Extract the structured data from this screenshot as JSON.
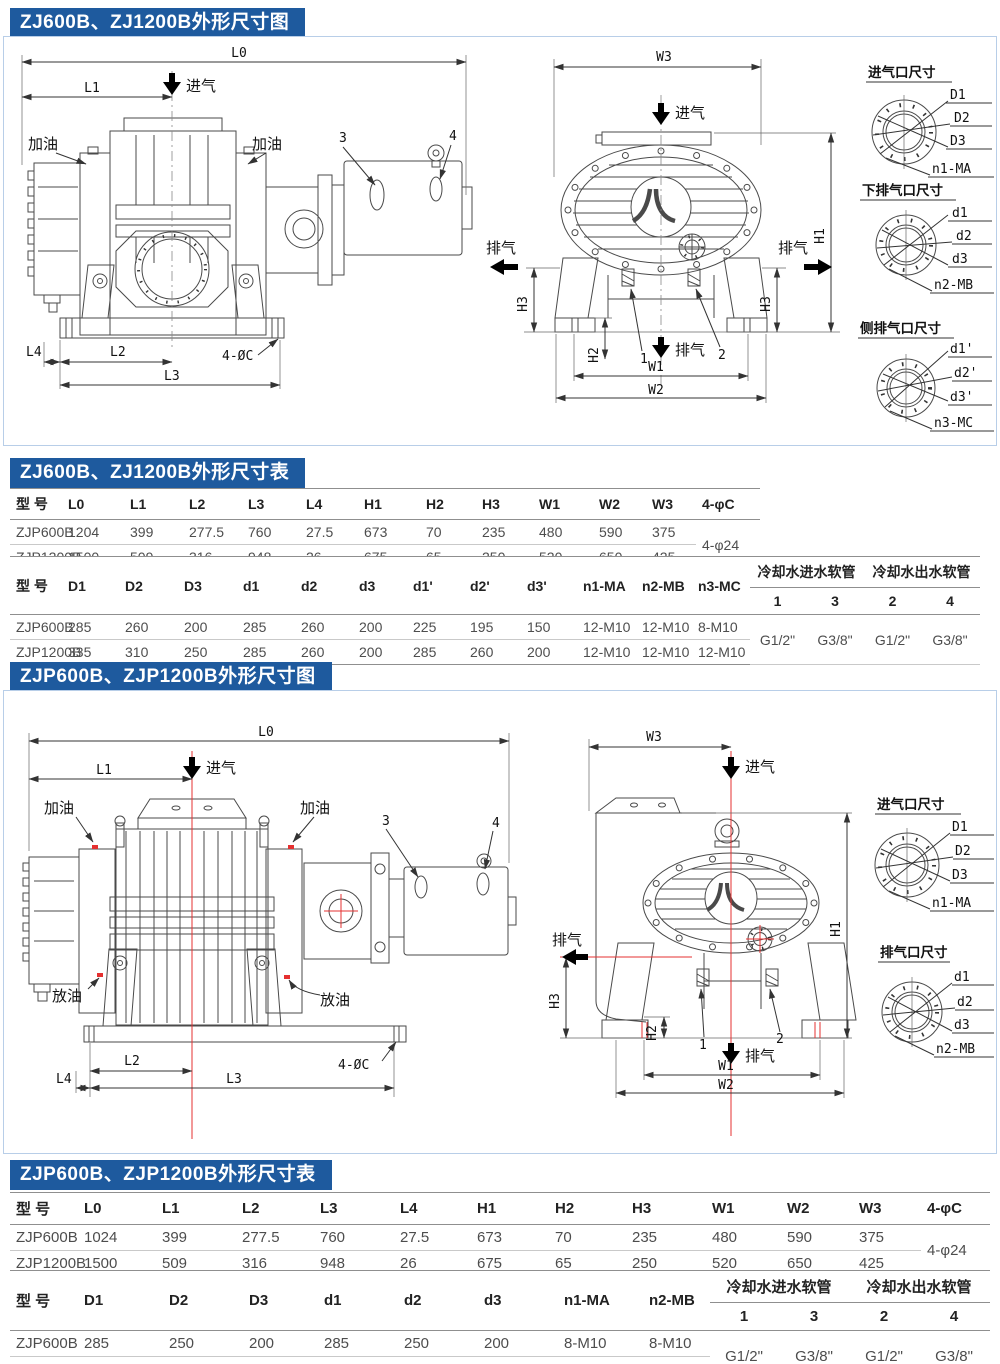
{
  "page": {
    "accent": "#1e5a9e",
    "frame_line": "#b8cee8",
    "centerline_red": "#e53030"
  },
  "fig1": {
    "title": "ZJ600B、ZJ1200B外形尺寸图",
    "side": {
      "l0": "L0",
      "l1": "L1",
      "inlet": "进气",
      "oil_left": "加油",
      "oil_right": "加油",
      "p3": "3",
      "p4": "4",
      "l4": "L4",
      "l2": "L2",
      "l3": "L3",
      "bolt": "4-ØC"
    },
    "front": {
      "w3": "W3",
      "inlet": "进气",
      "ex_left": "排气",
      "ex_right": "排气",
      "h1": "H1",
      "h3l": "H3",
      "h3r": "H3",
      "h2": "H2",
      "p1": "1",
      "p2": "2",
      "ex_bottom": "排气",
      "w1": "W1",
      "w2": "W2"
    },
    "fl1": {
      "title": "进气口尺寸",
      "a": "D1",
      "b": "D2",
      "c": "D3",
      "d": "n1-MA"
    },
    "fl2": {
      "title": "下排气口尺寸",
      "a": "d1",
      "b": "d2",
      "c": "d3",
      "d": "n2-MB"
    },
    "fl3": {
      "title": "侧排气口尺寸",
      "a": "d1'",
      "b": "d2'",
      "c": "d3'",
      "d": "n3-MC"
    }
  },
  "t1": {
    "title": "ZJ600B、ZJ1200B外形尺寸表",
    "p1h": [
      "型 号",
      "L0",
      "L1",
      "L2",
      "L3",
      "L4",
      "H1",
      "H2",
      "H3",
      "W1",
      "W2",
      "W3",
      "4-φC"
    ],
    "p1r0": [
      "ZJP600B",
      "1204",
      "399",
      "277.5",
      "760",
      "27.5",
      "673",
      "70",
      "235",
      "480",
      "590",
      "375"
    ],
    "p1r1": [
      "ZJP1200B",
      "1500",
      "509",
      "316",
      "948",
      "26",
      "675",
      "65",
      "250",
      "520",
      "650",
      "425"
    ],
    "p1m": "4-φ24",
    "p2h": [
      "型 号",
      "D1",
      "D2",
      "D3",
      "d1",
      "d2",
      "d3",
      "d1'",
      "d2'",
      "d3'",
      "n1-MA",
      "n2-MB",
      "n3-MC"
    ],
    "g_in": "冷却水进水软管",
    "g_out": "冷却水出水软管",
    "g_in_cols": [
      "1",
      "3"
    ],
    "g_out_cols": [
      "2",
      "4"
    ],
    "p2r0": [
      "ZJP600B",
      "285",
      "260",
      "200",
      "285",
      "260",
      "200",
      "225",
      "195",
      "150",
      "12-M10",
      "12-M10",
      "8-M10"
    ],
    "p2r1": [
      "ZJP1200B",
      "335",
      "310",
      "250",
      "285",
      "260",
      "200",
      "285",
      "260",
      "200",
      "12-M10",
      "12-M10",
      "12-M10"
    ],
    "gv": [
      "G1/2\"",
      "G3/8\"",
      "G1/2\"",
      "G3/8\""
    ]
  },
  "fig2": {
    "title": "ZJP600B、ZJP1200B外形尺寸图",
    "side": {
      "l0": "L0",
      "l1": "L1",
      "inlet": "进气",
      "oil_left": "加油",
      "oil_right": "加油",
      "p3": "3",
      "p4": "4",
      "drain_left": "放油",
      "drain_right": "放油",
      "l2": "L2",
      "l4": "L4",
      "l3": "L3",
      "bolt": "4-ØC"
    },
    "front": {
      "w3": "W3",
      "inlet": "进气",
      "ex_left": "排气",
      "h1": "H1",
      "h3": "H3",
      "h2": "H2",
      "p1": "1",
      "p2": "2",
      "ex_bottom": "排气",
      "w1": "W1",
      "w2": "W2"
    },
    "fl1": {
      "title": "进气口尺寸",
      "a": "D1",
      "b": "D2",
      "c": "D3",
      "d": "n1-MA"
    },
    "fl2": {
      "title": "排气口尺寸",
      "a": "d1",
      "b": "d2",
      "c": "d3",
      "d": "n2-MB"
    }
  },
  "t2": {
    "title": "ZJP600B、ZJP1200B外形尺寸表",
    "p1h": [
      "型 号",
      "L0",
      "L1",
      "L2",
      "L3",
      "L4",
      "H1",
      "H2",
      "H3",
      "W1",
      "W2",
      "W3",
      "4-φC"
    ],
    "p1r0": [
      "ZJP600B",
      "1024",
      "399",
      "277.5",
      "760",
      "27.5",
      "673",
      "70",
      "235",
      "480",
      "590",
      "375"
    ],
    "p1r1": [
      "ZJP1200B",
      "1500",
      "509",
      "316",
      "948",
      "26",
      "675",
      "65",
      "250",
      "520",
      "650",
      "425"
    ],
    "p1m": "4-φ24",
    "p2h": [
      "型 号",
      "D1",
      "D2",
      "D3",
      "d1",
      "d2",
      "d3",
      "n1-MA",
      "n2-MB"
    ],
    "g_in": "冷却水进水软管",
    "g_out": "冷却水出水软管",
    "g_in_cols": [
      "1",
      "3"
    ],
    "g_out_cols": [
      "2",
      "4"
    ],
    "p2r0": [
      "ZJP600B",
      "285",
      "250",
      "200",
      "285",
      "250",
      "200",
      "8-M10",
      "8-M10"
    ],
    "p2r1": [
      "ZJP1200B",
      "335",
      "310",
      "250",
      "285",
      "260",
      "200",
      "12-M10",
      "12-M10"
    ],
    "gv": [
      "G1/2\"",
      "G3/8\"",
      "G1/2\"",
      "G3/8\""
    ]
  }
}
